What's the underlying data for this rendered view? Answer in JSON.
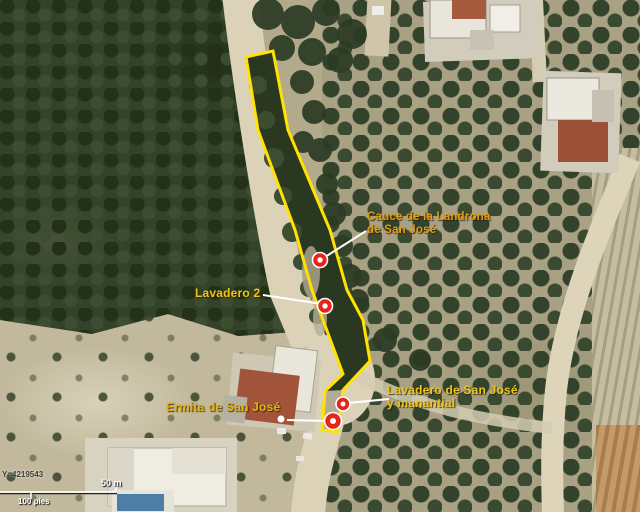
{
  "annotations": {
    "cauce": {
      "line1": "Cauce de la Landrona",
      "line2": "de San José"
    },
    "lavadero2": {
      "text": "Lavadero 2"
    },
    "ermita": {
      "text": "Ermita de San José"
    },
    "lavadero_sj": {
      "line1": "Lavadero de San José",
      "line2": "y manantial"
    }
  },
  "markers": {
    "style": "red circle with white center",
    "items": [
      "cauce-marker",
      "lavadero-2-marker",
      "lavadero-san-jose-marker",
      "ermita-marker"
    ]
  },
  "scalebar": {
    "coordinate": "Y=4219543",
    "primary_distance": "50 m",
    "secondary_distance": "100 pies"
  },
  "colors": {
    "outline_yellow": "#ffe200",
    "label_yellow": "#eec51c",
    "label_orange": "#e09c14",
    "marker_red": "#e52517",
    "leader_line": "#ffffff"
  }
}
